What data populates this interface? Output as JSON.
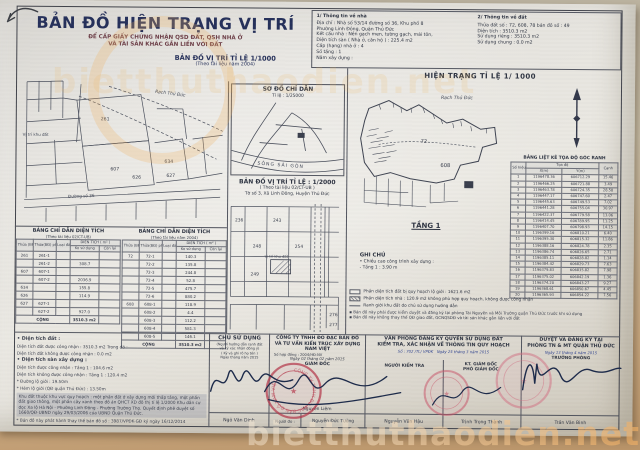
{
  "watermark": {
    "site": "bietthuthaodien.net"
  },
  "header": {
    "title": "BẢN ĐỒ HIỆN TRẠNG VỊ TRÍ",
    "subtitle1": "ĐỂ CẤP GIẤY CHỨNG NHẬN QSD ĐẤT, QSH NHÀ Ở",
    "subtitle2": "VÀ TÀI SẢN KHÁC GẮN LIỀN VỚI ĐẤT",
    "map1_title": "BẢN ĐỒ VỊ TRÍ TỈ LỆ 1/1000",
    "map1_note": "(Theo tài liệu năm 2004)"
  },
  "info_house": {
    "heading": "1/ Thông tin về nhà",
    "lines": [
      "Địa chỉ : Nhà số 53/14 đường số 36, Khu phố 8",
      "Phường Linh Đông, Quận Thủ Đức",
      "Kết cấu nhà : Nền gạch men, tường gạch, mái tôn,",
      "Diện tích sàn ( Nhà ở, căn hộ ) : 225.4 m2",
      "Cấp (hạng) nhà ở : 4",
      "Số tầng : 1",
      "Năm xây dựng :"
    ]
  },
  "info_land": {
    "heading": "2/ Thông tin về đất",
    "lines": [
      "Thửa đất số : 72, 608, 78  bản đồ số : 49",
      "Diện tích : 3510.3  m2",
      "Sử dụng riêng :  3510.3  m2",
      "Sử dụng chung :  0.0  m2"
    ]
  },
  "hien_trang": {
    "title": "HIỆN TRẠNG TỈ LỆ 1/ 1000",
    "floor": "TẦNG 1"
  },
  "so_do": {
    "title": "SƠ ĐỒ CHỈ DẪN",
    "scale": "Tỉ lệ : 1/25000",
    "river": "SÔNG SÀI GÒN"
  },
  "ban_do_2000": {
    "title": "BẢN ĐỒ VỊ TRÍ TỈ LỆ : 1/2000",
    "note1": "( Theo tài liệu 02/CT-UB )",
    "note2": "Tờ số 3, Xã Linh Đông, Huyện Thủ Đức"
  },
  "left_map": {
    "label_creek": "Rạch Thủ Đức",
    "label_site": "Vị trí khu đất",
    "label_road": "Đường số 36",
    "parcels": [
      "261",
      "607",
      "634",
      "626",
      "627"
    ]
  },
  "mid_map": {
    "label_site": "Vị trí khu đất",
    "parcels": [
      "236",
      "243",
      "248",
      "254",
      "249",
      "276",
      "277"
    ]
  },
  "right_map": {
    "label_creek": "Rạch Thủ Đức",
    "parcel_a": "72",
    "parcel_b": "608"
  },
  "coord_table": {
    "title": "BẢNG LIỆT KÊ TỌA ĐỘ GÓC RANH",
    "col_point": "Số hiệu điểm",
    "col_group": "Tọa độ",
    "col_x": "X(m)",
    "col_y": "Y(m)",
    "col_edge": "Cạnh",
    "rows": [
      [
        "1",
        "1196478.36",
        "606712.29",
        "15.46"
      ],
      [
        "2",
        "1196466.25",
        "606721.88",
        "3.49"
      ],
      [
        "3",
        "1196463.78",
        "606724.35",
        "28.58"
      ],
      [
        "4",
        "1196447.17",
        "606747.60",
        "2.47"
      ],
      [
        "5",
        "1196445.63",
        "606749.53",
        "7.02"
      ],
      [
        "6",
        "1196441.28",
        "606755.04",
        "30.97"
      ],
      [
        "7",
        "1196422.37",
        "606779.58",
        "13.06"
      ],
      [
        "8",
        "1196414.45",
        "606789.95",
        "11.25"
      ],
      [
        "9",
        "1196407.70",
        "606798.93",
        "14.15"
      ],
      [
        "10",
        "1196399.16",
        "606810.21",
        "6.40"
      ],
      [
        "11",
        "1196395.30",
        "606815.32",
        "11.86"
      ],
      [
        "12",
        "1196388.16",
        "606824.78",
        "2.35"
      ],
      [
        "13",
        "1196386.74",
        "606826.65",
        "2.71"
      ],
      [
        "14",
        "1196385.11",
        "606828.82",
        "1.14"
      ],
      [
        "15",
        "1196384.42",
        "606829.73",
        "7.63"
      ],
      [
        "16",
        "1196379.83",
        "606835.82",
        "7.98"
      ],
      [
        "17",
        "1196375.02",
        "606842.19",
        "1.36"
      ],
      [
        "18",
        "1196374.20",
        "606843.27",
        "9.27"
      ],
      [
        "19",
        "1196368.61",
        "606850.67",
        "4.45"
      ],
      [
        "20",
        "1196365.93",
        "606854.22",
        "7.56"
      ]
    ]
  },
  "area_table_left": {
    "title": "BẢNG CHỈ DẪN DIỆN TÍCH",
    "note": "(Theo tài liệu 02/CT-UB)",
    "h_thua": "Thửa (BĐ) số",
    "h_chiet": "Thửa(BĐ) phân chiết",
    "h_loai": "Loại đất",
    "h_dt": "DIỆN TÍCH ( m² )",
    "h_ko": "Ko sử dụng",
    "h_con": "Còn lại",
    "rows": [
      [
        "261",
        "261-1",
        ""
      ],
      [
        "",
        "261-2",
        "308.7"
      ],
      [
        "607",
        "607-1",
        ""
      ],
      [
        "",
        "607-2",
        "2036.9"
      ],
      [
        "634",
        "",
        "155.8"
      ],
      [
        "626",
        "",
        "114.9"
      ],
      [
        "627",
        "627-1",
        ""
      ],
      [
        "",
        "627-2",
        "927.0"
      ]
    ],
    "total_label": "CỘNG",
    "total": "3510.3 m2"
  },
  "area_table_right": {
    "title": "BẢNG CHỈ DẪN DIỆN TÍCH",
    "note": "(Theo tài liệu năm 2004)",
    "h_thua": "Thửa (BĐ) số",
    "h_chiet": "Thửa(BĐ) phân chiết",
    "h_loai": "Loại đất",
    "h_dt": "DIỆN TÍCH ( m² )",
    "h_ko": "Ko sử dụng",
    "h_con": "Còn lại",
    "rows": [
      [
        "72",
        "72-1",
        "140.3"
      ],
      [
        "",
        "72-2",
        "135.8"
      ],
      [
        "",
        "72-3",
        "244.8"
      ],
      [
        "",
        "72-4",
        "52.8"
      ],
      [
        "",
        "72-5",
        "475.7"
      ],
      [
        "",
        "72-6",
        "880.2"
      ],
      [
        "608",
        "608-1",
        "118.9"
      ],
      [
        "",
        "608-2",
        "4.4"
      ],
      [
        "",
        "608-3",
        "112.2"
      ],
      [
        "",
        "608-4",
        "581.3"
      ],
      [
        "",
        "608-5",
        "146.1"
      ]
    ],
    "total_label": "CỘNG",
    "total": "3510.3 m2"
  },
  "notes_left": {
    "lines": [
      {
        "t": "• Diện tích đất :",
        "cls": "b"
      },
      {
        "t": "Diện tích đất được công nhận : 3510.3 m2      Trong đó :"
      },
      {
        "t": "Diện tích đất không được công nhận : 0.0 m2"
      },
      {
        "t": "• Diện tích sàn xây dựng :",
        "cls": "b"
      },
      {
        "t": "Diện tích được công nhận :   Tầng 1 : 104.6 m2"
      },
      {
        "t": "Diện tích không được công nhận :   Tầng 1 : 120.4 m2"
      },
      {
        "t": "* Đường lộ giới : 19.50m"
      },
      {
        "t": "* Hẻm lộ giới (QĐ quận Thủ Đức) : 13.50m"
      },
      {
        "t": "Khu đất thuộc khu vực quy hoạch : một phần đất ở xây dựng mới thấp tầng, một phần đất giao thông, một phần cây xanh theo đồ án QHCT XD đô thị tỉ lệ 1/2000 Khu dân cư dọc Xa lộ Hà Nội - Phường Linh Đông - Phường Trường Thọ. Quyết định phê duyệt số 1660/QĐ-UBND ngày 29/03/2006 của UBND Quận Thủ Đức.",
        "cls": "hl"
      },
      {
        "t": "* Bản đồ này phát hành thay thế bản đồ số : 3987/VPĐK-GĐ ký ngày 16/12/2014"
      }
    ]
  },
  "ghi_chu": {
    "heading": "GHI CHÚ",
    "lines": [
      "• Chiều cao công trình xây dựng :",
      "- Tầng 1 :  3.90 m"
    ],
    "legend": [
      {
        "sw": "empty",
        "text": "Phần diện tích đất bị quy hoạch lộ giới : 1621.6 m2"
      },
      {
        "sw": "hatch",
        "text": "Phần diện tích nhà : 120.9 m2 không phù hợp quy hoạch, không được công nhận"
      },
      {
        "sw": "line",
        "text": "Ranh giới khu đất do chủ sử dụng hướng dẫn"
      }
    ],
    "notes": [
      "▪ Bản đồ này phải được kiểm duyệt và đăng ký tại phòng Tài Nguyên và Môi Trường quận Thủ Đức trước khi sử dụng",
      "▪ Bản đồ này không thay thế QĐ giao đất, GCNQSDĐ và tài sản khác gắn liền với đất"
    ]
  },
  "sign": {
    "owner": {
      "title": "CHỦ SỬ DỤNG",
      "note1": "(Người hướng dẫn ranh đất",
      "note2": "và ký xác nhận đồng ý)",
      "note3": "( Ký và ghi rõ họ tên )",
      "date": "Ngày       tháng       năm 2015",
      "name": "Ngô Văn Dinh"
    },
    "company": {
      "line1": "CÔNG TY TNHH ĐO ĐẠC BẢN ĐỒ",
      "line2": "VÀ TƯ VẤN KIẾN TRÚC XÂY DỰNG",
      "line3": "NAM VIỆT",
      "contract": "Số hợp đồng : 2004/HĐ-NV",
      "date": "Ngày 02 tháng 02 năm 2015",
      "role": "GIÁM ĐỐC",
      "name": "Nguyễn Liêm",
      "surveyor_label": "Người đo :",
      "surveyor": "Nguyễn Đức Tưởng"
    },
    "office": {
      "line1": "VĂN PHÒNG ĐĂNG KÝ QUYỀN SỬ DỤNG ĐẤT",
      "line2": "KIỂM TRA, XÁC NHẬN VỀ THÔNG TIN QUY HOẠCH",
      "so": "Số : 702 /TL/ VPĐK",
      "date": "Ngày 25 tháng 3 năm 2015",
      "checker_role": "NGƯỜI KIỂM TRA",
      "checker": "Nguyễn Văn Hậu",
      "role1": "KT. GIÁM ĐỐC",
      "role2": "PHÓ GIÁM ĐỐC",
      "name": "Trịnh Trọng Thành"
    },
    "approve": {
      "line1": "DUYỆT VÀ ĐĂNG KÝ TẠI",
      "line2": "PHÒNG TN & MT QUẬN THỦ ĐỨC",
      "date": "Ngày 13 tháng 4 năm 2015",
      "role": "TRƯỞNG PHÒNG",
      "name": "Trần Văn Bình"
    }
  },
  "stamps": {
    "ring1": "CÔNG TY TNHH ĐO ĐẠC BẢN ĐỒ NAM VIỆT"
  }
}
